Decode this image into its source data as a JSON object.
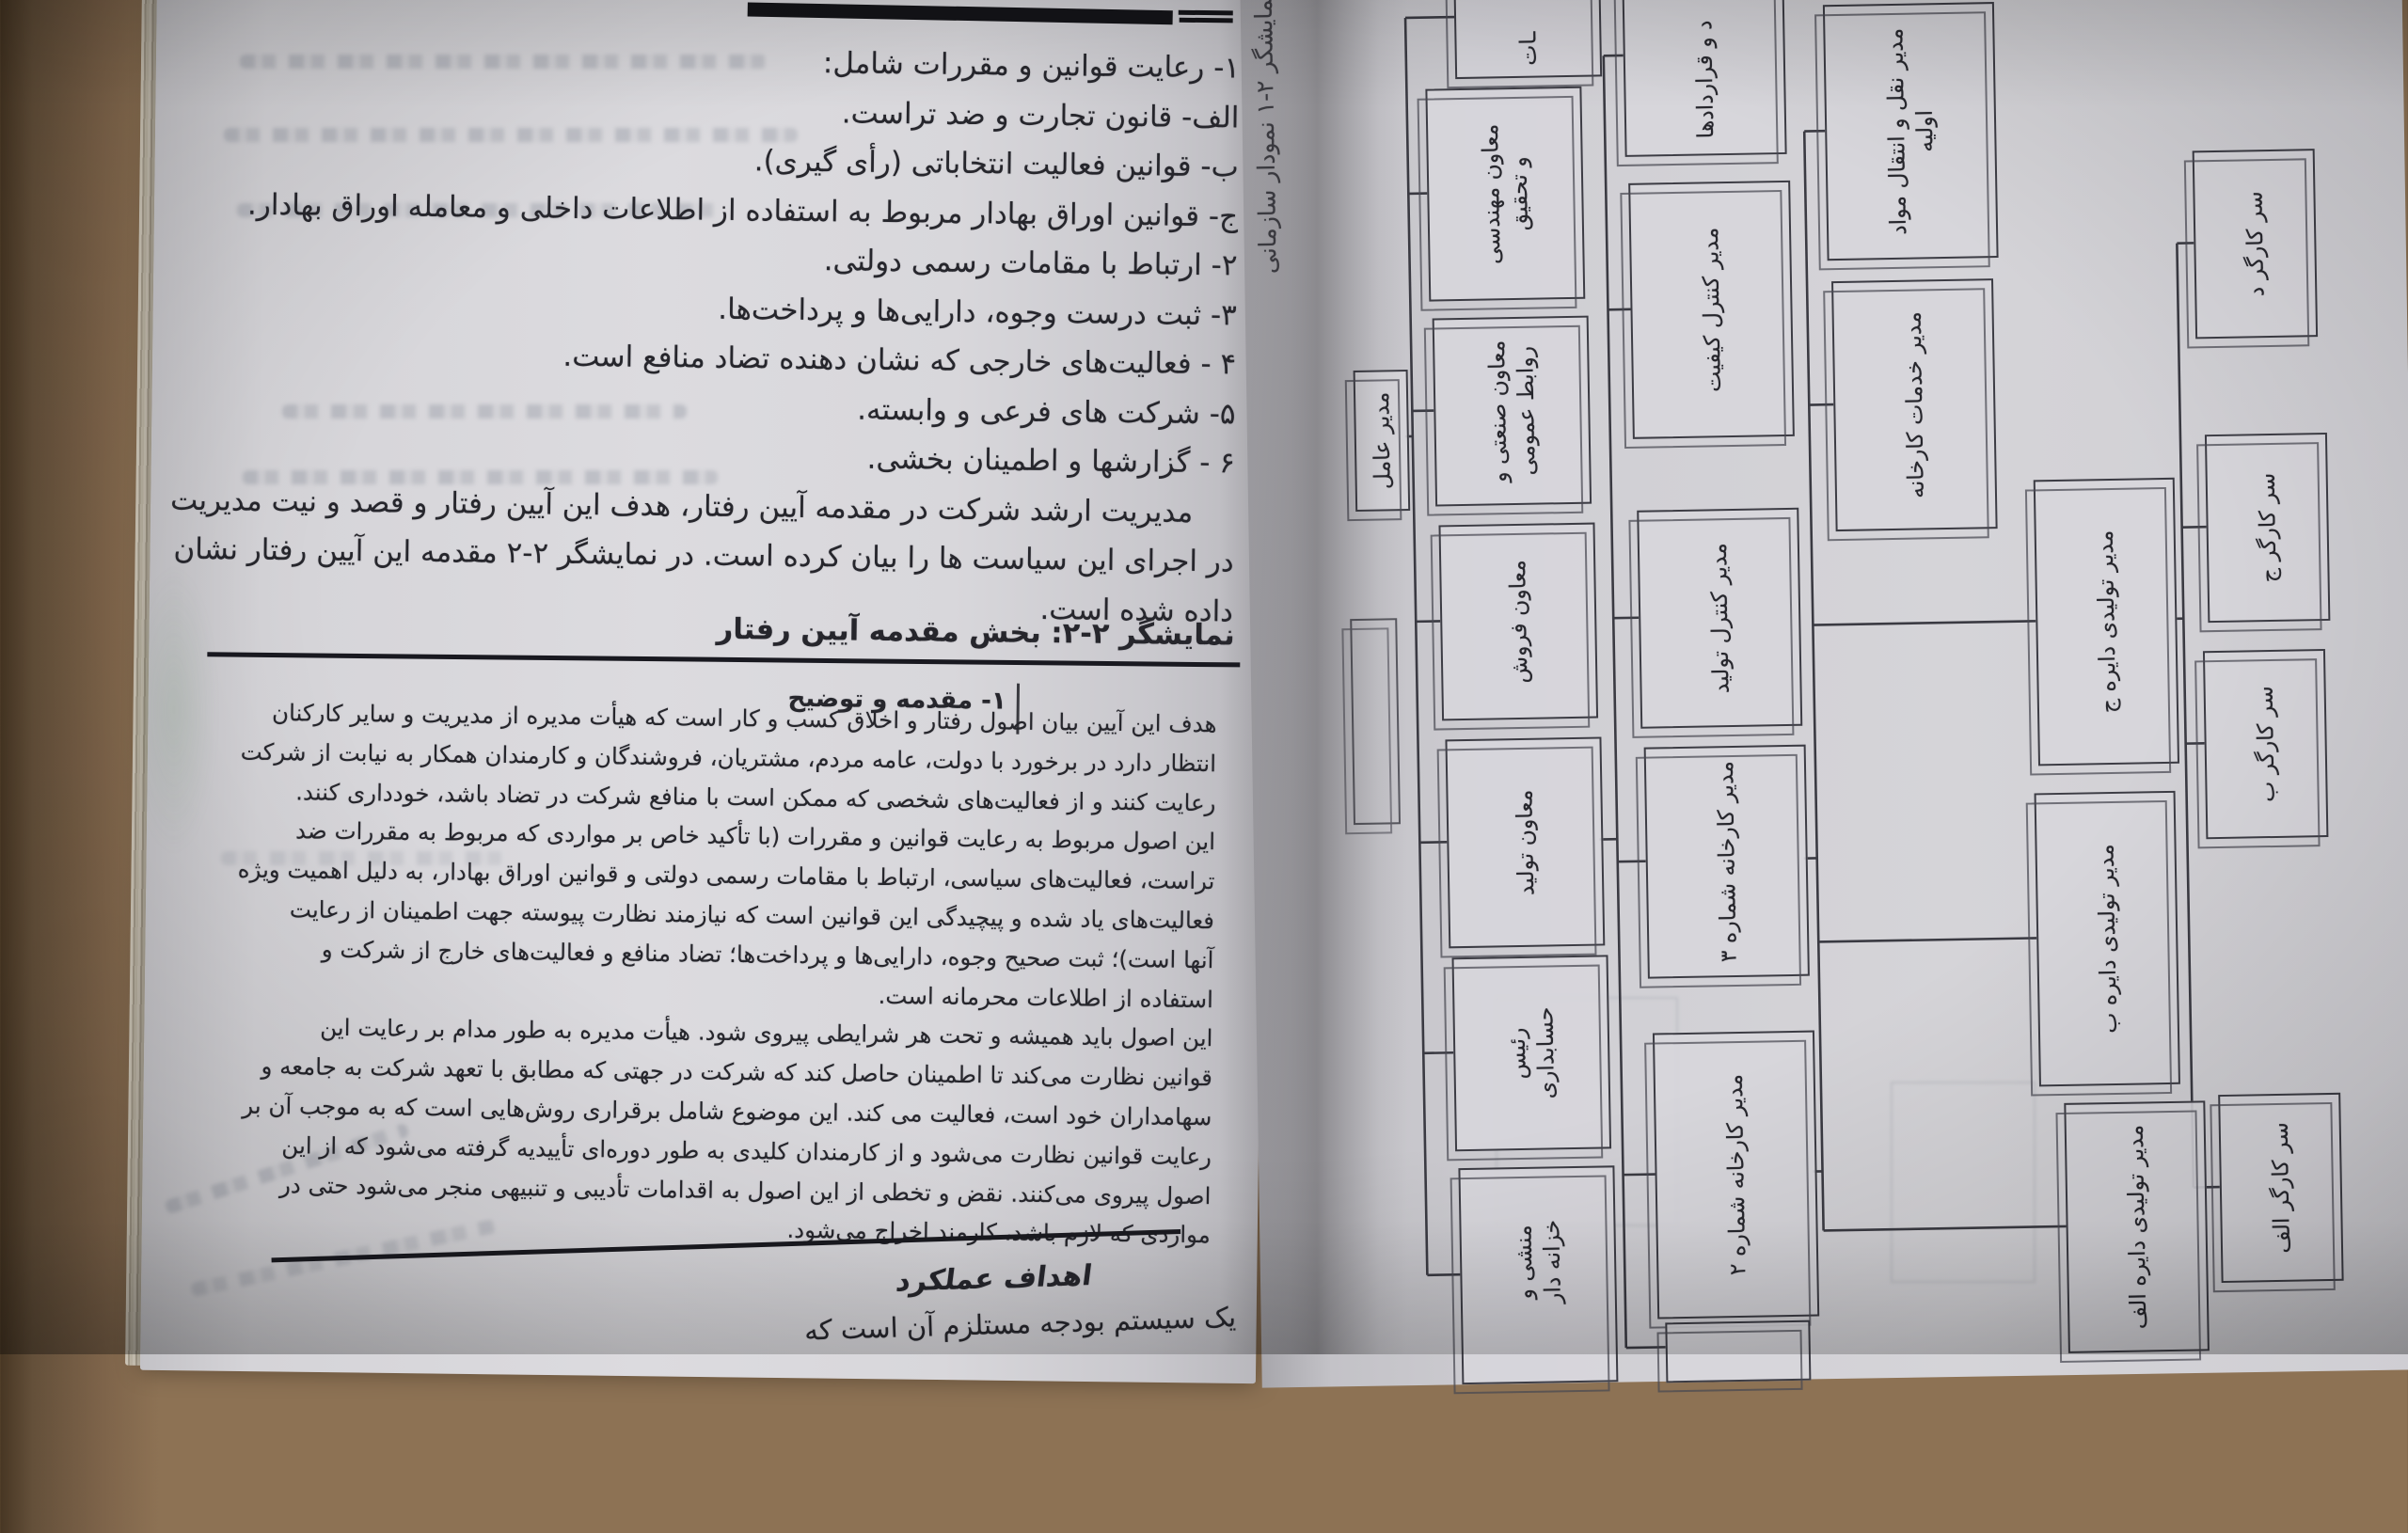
{
  "left_page": {
    "list_lines": [
      "۱- رعایت قوانین و مقررات شامل:",
      "الف- قانون تجارت و ضد تراست.",
      "ب- قوانین فعالیت انتخاباتی (رأی گیری).",
      "ج- قوانین اوراق بهادار مربوط به استفاده از اطلاعات داخلی و معامله اوراق بهادار.",
      "۲- ارتباط با مقامات رسمی دولتی.",
      "۳- ثبت درست وجوه، دارایی‌ها و پرداخت‌ها.",
      "۴ - فعالیت‌های خارجی که نشان دهنده تضاد منافع است.",
      "۵- شرکت های فرعی و وابسته.",
      "۶ - گزارشها و اطمینان بخشی."
    ],
    "paragraph_lines": [
      "مدیریت ارشد شرکت در مقدمه آیین رفتار، هدف این آیین رفتار و قصد و نیت مدیریت",
      "در اجرای این سیاست ها را بیان کرده است. در نمایشگر ۲-۲ مقدمه این آیین رفتار نشان",
      "داده شده است."
    ],
    "exhibit_title": "نمایشگر ۲-۲: بخش مقدمه آیین رفتار",
    "section_heading": "۱- مقدمه و توضیح",
    "body_lines": [
      "هدف این آیین بیان اصول رفتار و اخلاق کسب و کار است که هیأت مدیره از مدیریت و سایر کارکنان",
      "انتظار دارد در برخورد با دولت، عامه مردم، مشتریان، فروشندگان و کارمندان همکار به نیابت از شرکت",
      "رعایت کنند و از فعالیت‌های شخصی که ممکن است با منافع شرکت در تضاد باشد، خودداری کنند.",
      "این اصول مربوط به رعایت قوانین و مقررات (با تأکید خاص بر مواردی که مربوط به مقررات ضد",
      "تراست، فعالیت‌های سیاسی، ارتباط با مقامات رسمی دولتی و قوانین اوراق بهادار، به دلیل اهمیت ویژه",
      "فعالیت‌های یاد شده و پیچیدگی این قوانین است که نیازمند نظارت پیوسته جهت اطمینان از رعایت",
      "آنها است)؛ ثبت صحیح وجوه، دارایی‌ها و پرداخت‌ها؛ تضاد منافع و فعالیت‌های خارج از شرکت و",
      "استفاده از اطلاعات محرمانه است.",
      "این اصول باید همیشه و تحت هر شرایطی پیروی شود. هیأت مدیره به طور مدام بر رعایت این",
      "قوانین نظارت می‌کند تا اطمینان حاصل کند که شرکت در جهتی که مطابق با تعهد شرکت به جامعه و",
      "سهامداران خود است، فعالیت می کند. این موضوع شامل برقراری روش‌هایی است که به موجب آن بر",
      "رعایت قوانین نظارت می‌شود و از کارمندان کلیدی به طور دوره‌ای تأییدیه گرفته می‌شود که از این",
      "اصول پیروی می‌کنند. نقض و تخطی از این اصول به اقدامات تأدیبی و تنبیهی منجر می‌شود حتی در",
      "مواردی که لازم باشد، کارمند اخراج می‌شود."
    ],
    "footer_heading": "اهداف عملکرد",
    "footer_partial_line": "یک سیستم بودجه مستلزم آن است که"
  },
  "right_page": {
    "exhibit_caption": "نمایشگر ۲-۱ نمودار سازمانی",
    "org_chart": {
      "ceo": "مدیر عامل",
      "a0": "ـات",
      "a1": "معاون مهندسی\nو تحقیق",
      "a2": "معاون صنعتی و\nروابط عمومی",
      "a3": "معاون فروش",
      "a4": "معاون تولید",
      "a5": "رئیس\nحسابداری",
      "a6": "منشی و\nخزانه دار",
      "b1": "د و قراردادها",
      "b2": "مدیر کنترل کیفیت",
      "b3": "مدیر کنترل تولید",
      "b4": "مدیر کارخانه شماره ۳",
      "b5": "مدیر کارخانه شماره ۲",
      "c1": "مدیر نقل و انتقال مواد\nاولیه",
      "c2": "مدیر خدمات کارخانه",
      "c3": "مدیر تولیدی دایره ج",
      "c4": "مدیر تولیدی دایره ب",
      "c5": "مدیر تولیدی دایره الف",
      "d1": "سر کارگر د",
      "d2": "سر کارگر ج",
      "d3": "سر کارگر ب",
      "d4": "سر کارگر الف"
    }
  }
}
